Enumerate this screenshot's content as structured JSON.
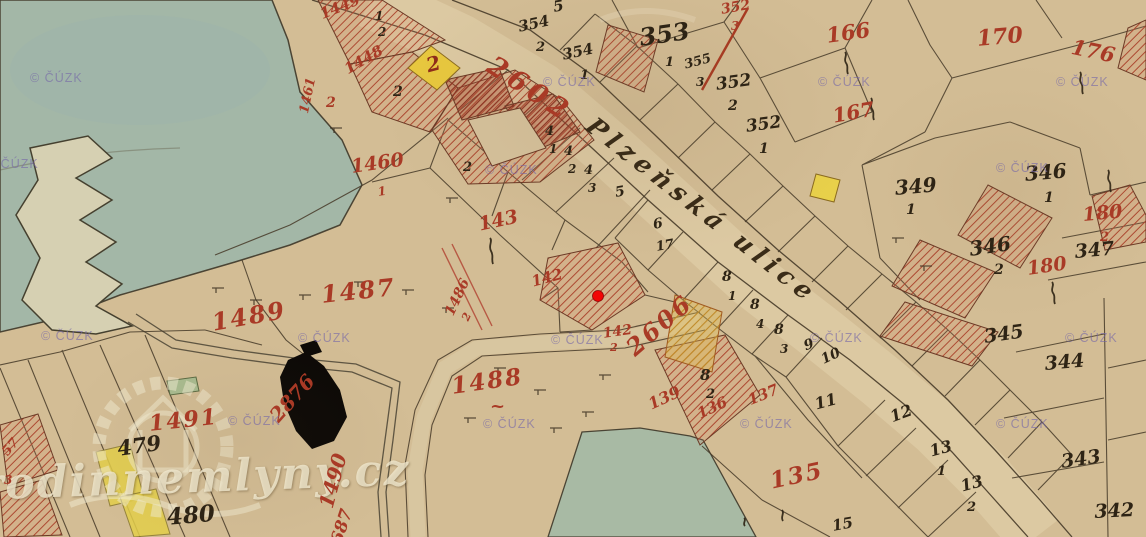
{
  "map": {
    "street_name": "Plzeňská ulice",
    "marker_color": "#f20505",
    "colors": {
      "paper": "#d3bd95",
      "water": "#a3b7a7",
      "road": "#dcc9a2",
      "red_label": "#a93a26",
      "black_label": "#2e2415",
      "building_hatch": "#ad4a32",
      "yellow_parcel": "#e8c83e"
    },
    "labels_black": [
      {
        "t": "5",
        "x": 552,
        "y": 0,
        "s": 15,
        "r": -10
      },
      {
        "t": "354",
        "x": 517,
        "y": 20,
        "s": 15,
        "r": -12
      },
      {
        "t": "2",
        "x": 536,
        "y": 41,
        "s": 13,
        "r": 0
      },
      {
        "t": "354",
        "x": 561,
        "y": 48,
        "s": 15,
        "r": -12
      },
      {
        "t": "1",
        "x": 580,
        "y": 69,
        "s": 13,
        "r": 0
      },
      {
        "t": "353",
        "x": 638,
        "y": 26,
        "s": 24,
        "r": -8
      },
      {
        "t": "1",
        "x": 665,
        "y": 56,
        "s": 13,
        "r": 0
      },
      {
        "t": "355",
        "x": 683,
        "y": 59,
        "s": 13,
        "r": -15
      },
      {
        "t": "3",
        "x": 696,
        "y": 76,
        "s": 12,
        "r": 0
      },
      {
        "t": "352",
        "x": 715,
        "y": 77,
        "s": 17,
        "r": -8
      },
      {
        "t": "2",
        "x": 728,
        "y": 99,
        "s": 14,
        "r": 0
      },
      {
        "t": "352",
        "x": 745,
        "y": 119,
        "s": 17,
        "r": -8
      },
      {
        "t": "1",
        "x": 759,
        "y": 142,
        "s": 14,
        "r": 0
      },
      {
        "t": "349",
        "x": 894,
        "y": 178,
        "s": 20,
        "r": -5
      },
      {
        "t": "1",
        "x": 906,
        "y": 203,
        "s": 14,
        "r": 0
      },
      {
        "t": "346",
        "x": 1024,
        "y": 164,
        "s": 20,
        "r": -5
      },
      {
        "t": "1",
        "x": 1044,
        "y": 191,
        "s": 14,
        "r": 0
      },
      {
        "t": "346",
        "x": 968,
        "y": 239,
        "s": 20,
        "r": -8
      },
      {
        "t": "2",
        "x": 994,
        "y": 263,
        "s": 14,
        "r": 0
      },
      {
        "t": "347",
        "x": 1074,
        "y": 243,
        "s": 19,
        "r": -5
      },
      {
        "t": "345",
        "x": 983,
        "y": 328,
        "s": 19,
        "r": -8
      },
      {
        "t": "344",
        "x": 1044,
        "y": 355,
        "s": 19,
        "r": -5
      },
      {
        "t": "343",
        "x": 1060,
        "y": 453,
        "s": 19,
        "r": -8
      },
      {
        "t": "342",
        "x": 1094,
        "y": 503,
        "s": 19,
        "r": -3
      },
      {
        "t": "13",
        "x": 928,
        "y": 444,
        "s": 16,
        "r": -15
      },
      {
        "t": "1",
        "x": 937,
        "y": 465,
        "s": 13,
        "r": 0
      },
      {
        "t": "13",
        "x": 959,
        "y": 479,
        "s": 16,
        "r": -15
      },
      {
        "t": "2",
        "x": 967,
        "y": 501,
        "s": 13,
        "r": 0
      },
      {
        "t": "12",
        "x": 888,
        "y": 410,
        "s": 16,
        "r": -20
      },
      {
        "t": "11",
        "x": 813,
        "y": 397,
        "s": 16,
        "r": -15
      },
      {
        "t": "8",
        "x": 700,
        "y": 368,
        "s": 15,
        "r": 0
      },
      {
        "t": "2",
        "x": 706,
        "y": 388,
        "s": 13,
        "r": 0
      },
      {
        "t": "8",
        "x": 722,
        "y": 270,
        "s": 14,
        "r": 0
      },
      {
        "t": "1",
        "x": 728,
        "y": 290,
        "s": 12,
        "r": 0
      },
      {
        "t": "8",
        "x": 750,
        "y": 298,
        "s": 14,
        "r": 0
      },
      {
        "t": "4",
        "x": 756,
        "y": 318,
        "s": 12,
        "r": 0
      },
      {
        "t": "8",
        "x": 774,
        "y": 323,
        "s": 14,
        "r": 0
      },
      {
        "t": "3",
        "x": 780,
        "y": 343,
        "s": 12,
        "r": 0
      },
      {
        "t": "9",
        "x": 802,
        "y": 340,
        "s": 14,
        "r": -20
      },
      {
        "t": "10",
        "x": 819,
        "y": 354,
        "s": 14,
        "r": -25
      },
      {
        "t": "4",
        "x": 545,
        "y": 125,
        "s": 13,
        "r": 0
      },
      {
        "t": "1",
        "x": 549,
        "y": 143,
        "s": 12,
        "r": 0
      },
      {
        "t": "4",
        "x": 564,
        "y": 145,
        "s": 13,
        "r": 0
      },
      {
        "t": "2",
        "x": 568,
        "y": 163,
        "s": 12,
        "r": 0
      },
      {
        "t": "4",
        "x": 584,
        "y": 164,
        "s": 13,
        "r": 0
      },
      {
        "t": "3",
        "x": 588,
        "y": 182,
        "s": 12,
        "r": 0
      },
      {
        "t": "5",
        "x": 614,
        "y": 186,
        "s": 14,
        "r": -10
      },
      {
        "t": "6",
        "x": 652,
        "y": 218,
        "s": 14,
        "r": -10
      },
      {
        "t": "17",
        "x": 655,
        "y": 241,
        "s": 13,
        "r": -10
      },
      {
        "t": "2",
        "x": 393,
        "y": 85,
        "s": 14,
        "r": 0
      },
      {
        "t": "1",
        "x": 375,
        "y": 10,
        "s": 12,
        "r": 0
      },
      {
        "t": "2",
        "x": 378,
        "y": 26,
        "s": 12,
        "r": 0
      },
      {
        "t": "2",
        "x": 463,
        "y": 161,
        "s": 13,
        "r": 0
      },
      {
        "t": "479",
        "x": 116,
        "y": 438,
        "s": 21,
        "r": -8
      },
      {
        "t": "480",
        "x": 166,
        "y": 506,
        "s": 23,
        "r": -5
      },
      {
        "t": "15",
        "x": 831,
        "y": 519,
        "s": 15,
        "r": -10
      }
    ],
    "labels_red": [
      {
        "t": "2602",
        "x": 497,
        "y": 52,
        "s": 27,
        "r": 33,
        "sp": 5
      },
      {
        "t": "2606",
        "x": 622,
        "y": 342,
        "s": 24,
        "r": -41,
        "sp": 3
      },
      {
        "t": "166",
        "x": 825,
        "y": 25,
        "s": 21,
        "r": -8
      },
      {
        "t": "170",
        "x": 976,
        "y": 28,
        "s": 22,
        "r": -5
      },
      {
        "t": "176",
        "x": 1074,
        "y": 36,
        "s": 21,
        "r": 12
      },
      {
        "t": "167",
        "x": 831,
        "y": 106,
        "s": 20,
        "r": -10
      },
      {
        "t": "143",
        "x": 477,
        "y": 216,
        "s": 19,
        "r": -12
      },
      {
        "t": "1460",
        "x": 350,
        "y": 158,
        "s": 19,
        "r": -8
      },
      {
        "t": "1",
        "x": 377,
        "y": 186,
        "s": 12,
        "r": -8
      },
      {
        "t": "1461",
        "x": 298,
        "y": 112,
        "s": 13,
        "r": -78
      },
      {
        "t": "1449",
        "x": 318,
        "y": 8,
        "s": 15,
        "r": -22
      },
      {
        "t": "1448",
        "x": 342,
        "y": 64,
        "s": 15,
        "r": -30
      },
      {
        "t": "2",
        "x": 326,
        "y": 96,
        "s": 14,
        "r": 0
      },
      {
        "t": "1487",
        "x": 320,
        "y": 283,
        "s": 24,
        "r": -6,
        "sp": 2
      },
      {
        "t": "1489",
        "x": 210,
        "y": 311,
        "s": 24,
        "r": -10,
        "sp": 2
      },
      {
        "t": "1491",
        "x": 148,
        "y": 413,
        "s": 22,
        "r": -6,
        "sp": 2
      },
      {
        "t": "1488",
        "x": 450,
        "y": 375,
        "s": 23,
        "r": -8,
        "sp": 2
      },
      {
        "t": "~",
        "x": 490,
        "y": 398,
        "s": 18,
        "r": 0
      },
      {
        "t": "1490",
        "x": 316,
        "y": 505,
        "s": 20,
        "r": -75
      },
      {
        "t": "687",
        "x": 329,
        "y": 541,
        "s": 17,
        "r": -72
      },
      {
        "t": "2876",
        "x": 266,
        "y": 412,
        "s": 20,
        "r": -48
      },
      {
        "t": "142",
        "x": 530,
        "y": 275,
        "s": 15,
        "r": -15
      },
      {
        "t": "142",
        "x": 602,
        "y": 327,
        "s": 14,
        "r": -8
      },
      {
        "t": "2",
        "x": 610,
        "y": 342,
        "s": 11,
        "r": 0
      },
      {
        "t": "1486",
        "x": 443,
        "y": 312,
        "s": 14,
        "r": -65
      },
      {
        "t": "2",
        "x": 460,
        "y": 318,
        "s": 11,
        "r": -65
      },
      {
        "t": "135",
        "x": 768,
        "y": 470,
        "s": 23,
        "r": -12,
        "sp": 2
      },
      {
        "t": "139",
        "x": 646,
        "y": 398,
        "s": 16,
        "r": -25
      },
      {
        "t": "136",
        "x": 695,
        "y": 408,
        "s": 15,
        "r": -25
      },
      {
        "t": "137",
        "x": 746,
        "y": 394,
        "s": 15,
        "r": -22
      },
      {
        "t": "180",
        "x": 1082,
        "y": 206,
        "s": 19,
        "r": -5
      },
      {
        "t": "2",
        "x": 1100,
        "y": 231,
        "s": 13,
        "r": 0
      },
      {
        "t": "180",
        "x": 1026,
        "y": 260,
        "s": 19,
        "r": -8
      },
      {
        "t": "352",
        "x": 720,
        "y": 3,
        "s": 14,
        "r": -10
      },
      {
        "t": "3",
        "x": 731,
        "y": 20,
        "s": 12,
        "r": 0
      },
      {
        "t": "57",
        "x": 0,
        "y": 450,
        "s": 13,
        "r": -50
      },
      {
        "t": "3",
        "x": 4,
        "y": 474,
        "s": 12,
        "r": 0
      },
      {
        "t": "2",
        "x": 424,
        "y": 56,
        "s": 20,
        "r": -15,
        "c": "#8e2c1a"
      }
    ]
  },
  "watermarks": {
    "cuzk": {
      "text": "© ČÚZK",
      "positions": [
        [
          30,
          72
        ],
        [
          543,
          76
        ],
        [
          818,
          76
        ],
        [
          1056,
          76
        ],
        [
          -14,
          158
        ],
        [
          485,
          164
        ],
        [
          996,
          162
        ],
        [
          41,
          330
        ],
        [
          298,
          332
        ],
        [
          551,
          334
        ],
        [
          810,
          332
        ],
        [
          1065,
          332
        ],
        [
          228,
          415
        ],
        [
          483,
          418
        ],
        [
          740,
          418
        ],
        [
          996,
          418
        ]
      ]
    },
    "site": {
      "text": "rodinnemlyny.cz"
    }
  }
}
